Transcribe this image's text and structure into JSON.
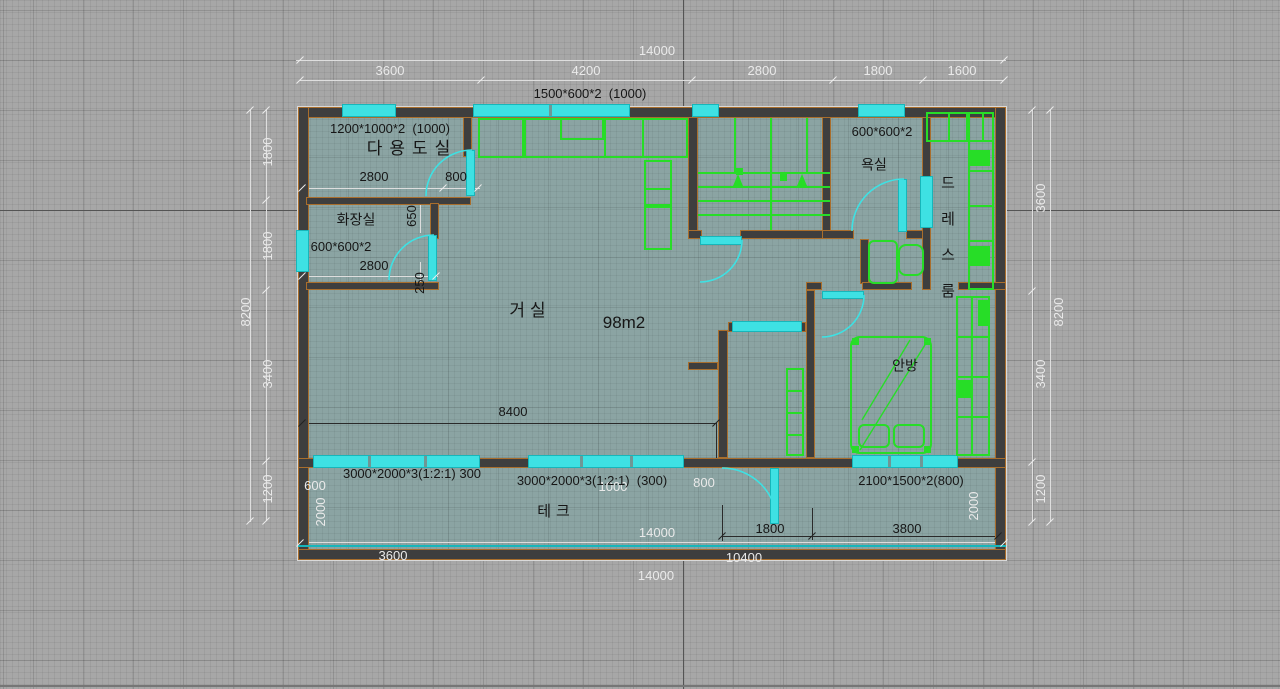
{
  "colors": {
    "background": "#a7a7a7",
    "floor_fill": "#8ba4a3",
    "wall": "#3e3e3e",
    "wall_edge": "#a96e2c",
    "window_cyan": "#3ee1e3",
    "furniture_green": "#27dd27",
    "dim_text_light": "#eaeaea",
    "dim_text_dark": "#161616"
  },
  "plan_summary": {
    "total_width": "14000",
    "total_depth": "8200",
    "floor_area": "98m2",
    "room_names": [
      "다용도실",
      "화장실",
      "거실",
      "욕실",
      "드레스룸",
      "안방",
      "테크"
    ]
  },
  "labels": [
    {
      "n": "dim-top-total",
      "t": "14000",
      "x": 657,
      "y": 51,
      "c": "l"
    },
    {
      "n": "dim-top-3600",
      "t": "3600",
      "x": 390,
      "y": 71,
      "c": "l"
    },
    {
      "n": "dim-top-4200",
      "t": "4200",
      "x": 586,
      "y": 71,
      "c": "l"
    },
    {
      "n": "dim-top-2800",
      "t": "2800",
      "x": 762,
      "y": 71,
      "c": "l"
    },
    {
      "n": "dim-top-1800",
      "t": "1800",
      "x": 878,
      "y": 71,
      "c": "l"
    },
    {
      "n": "dim-top-1600",
      "t": "1600",
      "x": 962,
      "y": 71,
      "c": "l"
    },
    {
      "n": "window-spec-kitchen",
      "t": "1500*600*2  (1000)",
      "x": 590,
      "y": 94,
      "c": "d"
    },
    {
      "n": "window-spec-utility",
      "t": "1200*1000*2  (1000)",
      "x": 390,
      "y": 129,
      "c": "d"
    },
    {
      "n": "room-label-utility",
      "t": "다용도실",
      "x": 412,
      "y": 149,
      "c": "d",
      "s": 17,
      "sp": 7
    },
    {
      "n": "dim-utility-2800",
      "t": "2800",
      "x": 374,
      "y": 177,
      "c": "d"
    },
    {
      "n": "dim-utility-800",
      "t": "800",
      "x": 456,
      "y": 177,
      "c": "d"
    },
    {
      "n": "dim-650",
      "t": "650",
      "x": 412,
      "y": 216,
      "c": "d",
      "r": 1
    },
    {
      "n": "room-label-toilet",
      "t": "화장실",
      "x": 356,
      "y": 220,
      "c": "d",
      "s": 14
    },
    {
      "n": "window-spec-toilet",
      "t": "600*600*2",
      "x": 341,
      "y": 247,
      "c": "d"
    },
    {
      "n": "dim-toilet-2800",
      "t": "2800",
      "x": 374,
      "y": 266,
      "c": "d"
    },
    {
      "n": "dim-250",
      "t": "250",
      "x": 420,
      "y": 283,
      "c": "d",
      "r": 1
    },
    {
      "n": "window-spec-bath",
      "t": "600*600*2",
      "x": 882,
      "y": 132,
      "c": "d"
    },
    {
      "n": "room-label-bath",
      "t": "욕실",
      "x": 874,
      "y": 165,
      "c": "d",
      "s": 14
    },
    {
      "n": "room-label-dress",
      "t": "드레스룸",
      "x": 948,
      "y": 238,
      "c": "d",
      "s": 15,
      "stack": 1
    },
    {
      "n": "dim-left-1800-a",
      "t": "1800",
      "x": 268,
      "y": 152,
      "c": "l",
      "r": 1
    },
    {
      "n": "dim-left-1800-b",
      "t": "1800",
      "x": 268,
      "y": 246,
      "c": "l",
      "r": 1
    },
    {
      "n": "dim-left-8200",
      "t": "8200",
      "x": 246,
      "y": 312,
      "c": "l",
      "r": 1
    },
    {
      "n": "dim-left-3400",
      "t": "3400",
      "x": 268,
      "y": 374,
      "c": "l",
      "r": 1
    },
    {
      "n": "dim-left-1200",
      "t": "1200",
      "x": 268,
      "y": 489,
      "c": "l",
      "r": 1
    },
    {
      "n": "dim-right-3600",
      "t": "3600",
      "x": 1041,
      "y": 198,
      "c": "l",
      "r": 1
    },
    {
      "n": "dim-right-8200",
      "t": "8200",
      "x": 1059,
      "y": 312,
      "c": "l",
      "r": 1
    },
    {
      "n": "dim-right-3400",
      "t": "3400",
      "x": 1041,
      "y": 374,
      "c": "l",
      "r": 1
    },
    {
      "n": "dim-right-1200",
      "t": "1200",
      "x": 1041,
      "y": 489,
      "c": "l",
      "r": 1
    },
    {
      "n": "room-label-living",
      "t": "거실",
      "x": 530,
      "y": 311,
      "c": "d",
      "s": 17,
      "sp": 5
    },
    {
      "n": "floor-area-label",
      "t": "98m2",
      "x": 624,
      "y": 323,
      "c": "d",
      "s": 17
    },
    {
      "n": "dim-8400",
      "t": "8400",
      "x": 513,
      "y": 412,
      "c": "d"
    },
    {
      "n": "room-label-master",
      "t": "안방",
      "x": 905,
      "y": 366,
      "c": "d",
      "s": 14
    },
    {
      "n": "window-spec-living-a",
      "t": "3000*2000*3(1:2:1) 300",
      "x": 412,
      "y": 474,
      "c": "d"
    },
    {
      "n": "dim-600",
      "t": "600",
      "x": 315,
      "y": 486,
      "c": "l"
    },
    {
      "n": "dim-2000-left",
      "t": "2000",
      "x": 321,
      "y": 512,
      "c": "l",
      "r": 1
    },
    {
      "n": "dim-1000",
      "t": "1000",
      "x": 613,
      "y": 487,
      "c": "l"
    },
    {
      "n": "window-spec-living-b",
      "t": "3000*2000*3(1:2:1)  (300)",
      "x": 592,
      "y": 481,
      "c": "d"
    },
    {
      "n": "dim-800-bottom",
      "t": "800",
      "x": 704,
      "y": 483,
      "c": "l"
    },
    {
      "n": "window-spec-master",
      "t": "2100*1500*2(800)",
      "x": 911,
      "y": 481,
      "c": "d"
    },
    {
      "n": "room-label-deck",
      "t": "테크",
      "x": 556,
      "y": 512,
      "c": "d",
      "s": 15,
      "sp": 5
    },
    {
      "n": "dim-deck-1800",
      "t": "1800",
      "x": 770,
      "y": 529,
      "c": "d"
    },
    {
      "n": "dim-deck-3800",
      "t": "3800",
      "x": 907,
      "y": 529,
      "c": "d"
    },
    {
      "n": "dim-2000-right",
      "t": "2000",
      "x": 974,
      "y": 506,
      "c": "l",
      "r": 1
    },
    {
      "n": "dim-deck-14000",
      "t": "14000",
      "x": 657,
      "y": 533,
      "c": "l"
    },
    {
      "n": "dim-bottom-3600",
      "t": "3600",
      "x": 393,
      "y": 556,
      "c": "l"
    },
    {
      "n": "dim-10400",
      "t": "10400",
      "x": 744,
      "y": 558,
      "c": "l"
    },
    {
      "n": "dim-bottom-14000",
      "t": "14000",
      "x": 656,
      "y": 576,
      "c": "l"
    }
  ]
}
